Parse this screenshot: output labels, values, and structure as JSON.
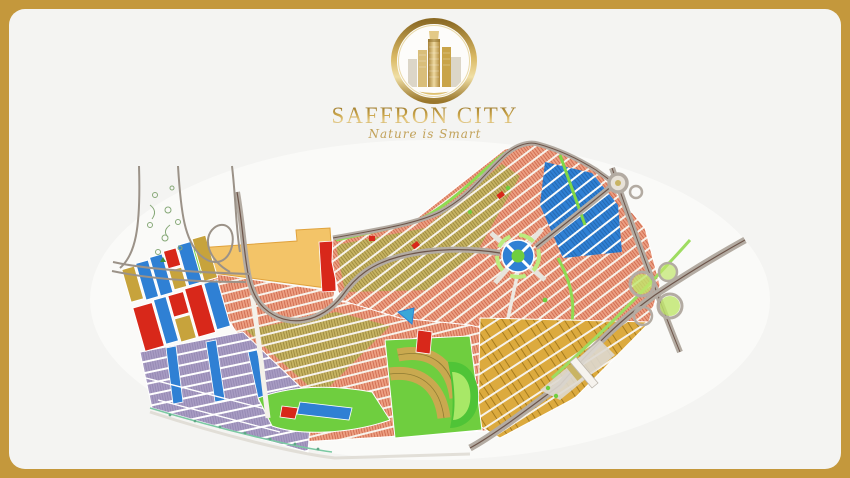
{
  "brand": {
    "title": "SAFFRON CITY",
    "tagline": "Nature is Smart",
    "emblem": "golden-skyline-medallion"
  },
  "frame": {
    "border_color": "#c4983c",
    "background": "#f4f4f2",
    "corner_radius_px": 16
  },
  "map": {
    "type": "master-plan",
    "palette": {
      "residential_salmon": "#eda083",
      "plot_hatch_red": "#c55b40",
      "olive_plots": "#c7b463",
      "commercial_blue": "#2f80d4",
      "reserved_red": "#d8281a",
      "commercial_yellow": "#f3c468",
      "purple_blocks": "#a89cc3",
      "gold_plots": "#dcaa3e",
      "park_green": "#6fce3f",
      "light_green": "#bdeb7e",
      "road_gray": "#b3aba2",
      "road_centerline": "#6e564b"
    },
    "features": [
      "left-highway-interchange",
      "tree-reserve",
      "yellow-commercial-strip",
      "central-roundabout",
      "crescent-park",
      "top-right-interchange",
      "east-cloverleaf-interchange",
      "main-entrance-gate",
      "boundary-highway"
    ]
  }
}
